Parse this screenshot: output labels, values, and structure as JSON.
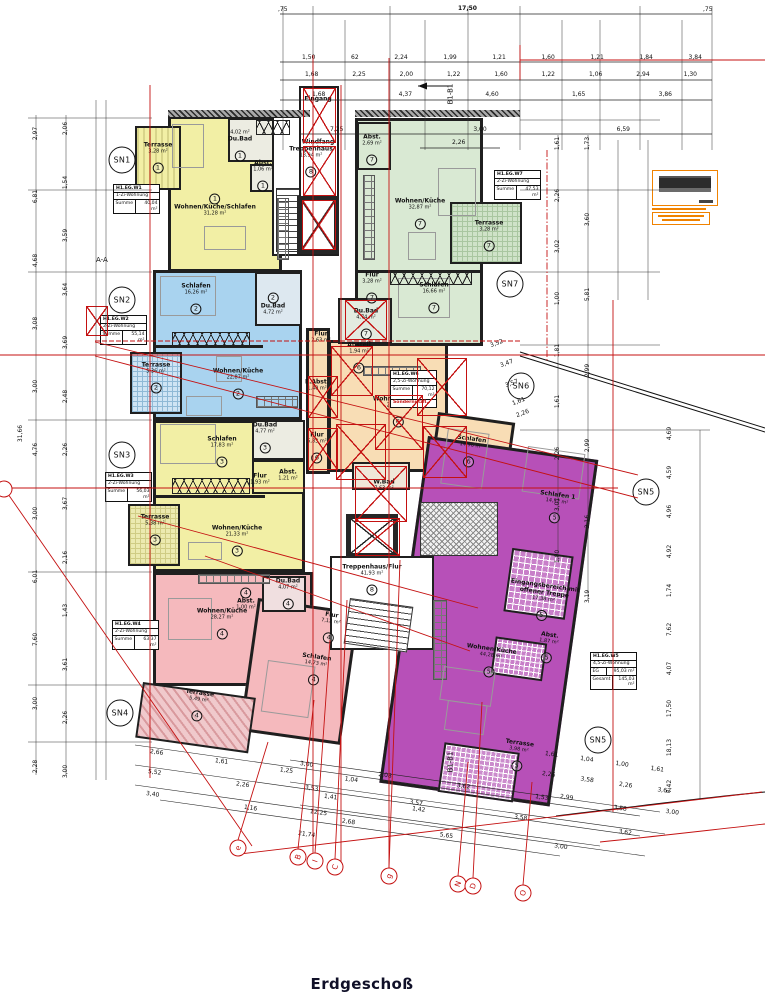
{
  "title": "Erdgeschoß",
  "sections": {
    "aa": "A-A",
    "b1": "B1-B1"
  },
  "colors": {
    "red_marks": "#c41111",
    "apt_yellow": "#f2efa5",
    "apt_blue": "#a9d3ef",
    "apt_green": "#d9e9d3",
    "apt_pink": "#f5b9bd",
    "apt_tan": "#f8ddb5",
    "apt_purple": "#b750b8",
    "stamp_orange": "#f08200"
  },
  "core": {
    "eingang": "Eingang",
    "windfang": "Windfang"
  },
  "rooms": {
    "t1": {
      "t": "Terrasse",
      "a": "3,28 m²",
      "n": "1"
    },
    "m1": {
      "t": "Wohnen/Küche/Schlafen",
      "a": "31,28 m²",
      "n": "1"
    },
    "b1": {
      "t": "Du.Bad",
      "a": "4,02 m²",
      "n": "1"
    },
    "ab1": {
      "t": "Abst.",
      "a": "1,06 m²",
      "n": "1"
    },
    "s2": {
      "t": "Schlafen",
      "a": "16,26 m²",
      "n": "2"
    },
    "bd2": {
      "t": "Du.Bad",
      "a": "4,72 m²",
      "n": "2"
    },
    "m2": {
      "t": "Wohnen/Küche",
      "a": "22,87 m²",
      "n": "2"
    },
    "t2": {
      "t": "Terrasse",
      "a": "5,36 m²",
      "n": "2"
    },
    "s3": {
      "t": "Schlafen",
      "a": "17,83 m²",
      "n": "3"
    },
    "bd3": {
      "t": "Du.Bad",
      "a": "4,77 m²",
      "n": "3"
    },
    "f3": {
      "t": "Flur",
      "a": "1,93 m²",
      "n": "3"
    },
    "ab3": {
      "t": "Abst.",
      "a": "1,21 m²",
      "n": "3"
    },
    "m3": {
      "t": "Wohnen/Küche",
      "a": "21,33 m²",
      "n": "3"
    },
    "t3": {
      "t": "Terrasse",
      "a": "5,38 m²",
      "n": "3"
    },
    "m4": {
      "t": "Wohnen/Küche",
      "a": "28,27 m²",
      "n": "4"
    },
    "ab4": {
      "t": "Abst.",
      "a": "1,00 m²",
      "n": "4"
    },
    "bd4": {
      "t": "Du.Bad",
      "a": "4,07 m²",
      "n": "4"
    },
    "f4": {
      "t": "Flur",
      "a": "7,12 m²",
      "n": "4"
    },
    "s4": {
      "t": "Schlafen",
      "a": "14,73 m²",
      "n": "4"
    },
    "t4": {
      "t": "Terrasse",
      "a": "5,49 m²",
      "n": "4"
    },
    "s5": {
      "t": "Schlafen 1",
      "a": "14,52 m²",
      "n": "5"
    },
    "e5": {
      "t": "Eingangsbereich mit offener Treppe",
      "a": "17,38 m²",
      "n": "5"
    },
    "ab5": {
      "t": "Abst.",
      "a": "1,87 m²",
      "n": "5"
    },
    "m5": {
      "t": "Wohnen/Küche",
      "a": "44,28 m²",
      "n": "5"
    },
    "t5": {
      "t": "Terrasse",
      "a": "3,98 m²",
      "n": "5"
    },
    "f6a": {
      "t": "Flur",
      "a": "2,63 m²",
      "n": "6"
    },
    "ab6": {
      "t": "Abstell",
      "a": "1,94 m²",
      "n": "6"
    },
    "e6": {
      "t": "E.Abst.",
      "a": "1,40 m²",
      "n": "6"
    },
    "f6b": {
      "t": "Flur",
      "a": "5,83 m²",
      "n": "6"
    },
    "wb6": {
      "t": "W.Bad",
      "a": "7,63 m²",
      "n": "6"
    },
    "m6": {
      "t": "Wohnen/Küche",
      "a": "23,75 m²",
      "n": "6"
    },
    "s6": {
      "t": "Schlafen",
      "a": "14,96 m²",
      "n": "6"
    },
    "ab7": {
      "t": "Abst.",
      "a": "2,69 m²",
      "n": "7"
    },
    "m7": {
      "t": "Wohnen/Küche",
      "a": "32,87 m²",
      "n": "7"
    },
    "t7": {
      "t": "Terrasse",
      "a": "3,28 m²",
      "n": "7"
    },
    "f7": {
      "t": "Flur",
      "a": "3,28 m²",
      "n": "7"
    },
    "bd7": {
      "t": "Du.Bad",
      "a": "4,74 m²",
      "n": "7"
    },
    "s7": {
      "t": "Schlafen",
      "a": "16,66 m²",
      "n": "7"
    },
    "tr8": {
      "t": "Treppenhaus",
      "a": "13,94 m²",
      "n": "8"
    },
    "tf8": {
      "t": "Treppenhaus/Flur",
      "a": "41,93 m²",
      "n": "8"
    }
  },
  "sn": {
    "s1": "SN1",
    "s2": "SN2",
    "s3": "SN3",
    "s4": "SN4",
    "s5": "SN5",
    "s6": "SN6",
    "s7": "SN7"
  },
  "info": {
    "w1": {
      "c": "H1.EG.W1",
      "t": "1-Zi-Wohnung",
      "r1l": "Summe",
      "r1v": "40,04 m²"
    },
    "w2": {
      "c": "H1.EG.W2",
      "t": "2-Zi-Wohnung",
      "r1l": "Summe",
      "r1v": "55,14 m²"
    },
    "w3": {
      "c": "H1.EG.W3",
      "t": "2-Zi-Wohnung",
      "r1l": "Summe",
      "r1v": "56,03 m²"
    },
    "w4": {
      "c": "H1.EG.W4",
      "t": "2-Zi-Wohnung",
      "r1l": "Summe",
      "r1v": "63,37 m²"
    },
    "w5": {
      "c": "H1.EG.W5",
      "t": "4,5-Zi-Wohnung",
      "r1l": "EG",
      "r1v": "95,03 m²",
      "r2l": "Gesamt",
      "r2v": "145,03 m²"
    },
    "w6": {
      "c": "H1.EG.W6",
      "t": "2,5-Zi-Wohnung",
      "r1l": "Summe",
      "r1v": "70,12 m²",
      "note": "Sondernutzfl."
    },
    "w7": {
      "c": "H1.EG.W7",
      "t": "2-Zi-Wohnung",
      "r1l": "Summe",
      "r1v": "47,53 m²"
    }
  },
  "dims": {
    "top_left": ",75",
    "top_total": "17,50",
    "top_right": ",75",
    "r1": [
      "1,50",
      "62",
      "2,24",
      "1,99",
      "1,21",
      "1,60",
      "1,21",
      "1,84",
      "3,84"
    ],
    "r2": [
      "1,68",
      "2,25",
      "2,00",
      "1,22",
      "1,60",
      "1,22",
      "1,06",
      "2,94",
      "1,30"
    ],
    "r3": [
      "1,68",
      "4,37",
      "4,60",
      "1,65",
      "3,86"
    ],
    "r4": [
      "7,25",
      "3,00",
      "6,59"
    ],
    "r5": "2,26",
    "left_outer": [
      "2,97",
      "6,81",
      "4,68",
      "3,08",
      "3,00",
      "4,76",
      "3,00",
      "6,01",
      "7,60",
      "3,00",
      "2,28"
    ],
    "left_inner": [
      "2,06",
      "1,54",
      "3,59",
      "3,64",
      "3,69",
      "2,48",
      "2,26",
      "3,67",
      "2,16",
      "1,43",
      "3,61",
      "2,26",
      "3,00"
    ],
    "left_total": "31,66",
    "right_c1": [
      "1,61",
      "2,26",
      "3,02",
      "1,00",
      "1,81",
      "1,61",
      "2,26",
      "3,01",
      "1,00"
    ],
    "right_c2": [
      "1,73",
      "3,60",
      "5,81",
      "2,99",
      "2,99",
      "2,16",
      "3,19"
    ],
    "right_c3": [
      "4,69",
      "4,59",
      "4,96",
      "4,92",
      "1,74",
      "7,62",
      "4,07",
      "17,50",
      "18,13",
      "7,42"
    ],
    "fan_right": [
      "3,52",
      "3,47",
      "3,57",
      "1,61",
      "2,26"
    ],
    "b1": [
      "2,66",
      "1,61",
      "1,25",
      "1,04"
    ],
    "b2": [
      "5,52",
      "2,26",
      "1,41",
      "1,42"
    ],
    "b3": [
      "3,40",
      "1,16",
      "2,68",
      "5,65"
    ],
    "b4": [
      "3,00",
      "2,08",
      "3,62",
      "1,53",
      "3,58"
    ],
    "b5": [
      "3,53",
      "3,57",
      "3,58",
      "3,62"
    ],
    "b6": [
      "12,25",
      "3,00"
    ],
    "b7": "21,74",
    "b8": [
      "1,61",
      "1,04",
      "1,00",
      "1,61"
    ],
    "b9": [
      "2,26",
      "3,58",
      "2,26",
      "3,62"
    ],
    "b10": [
      "2,99",
      "3,00"
    ]
  },
  "grid_markers": [
    "e",
    "B",
    "I",
    "C",
    "g",
    "N",
    "D",
    "O"
  ]
}
